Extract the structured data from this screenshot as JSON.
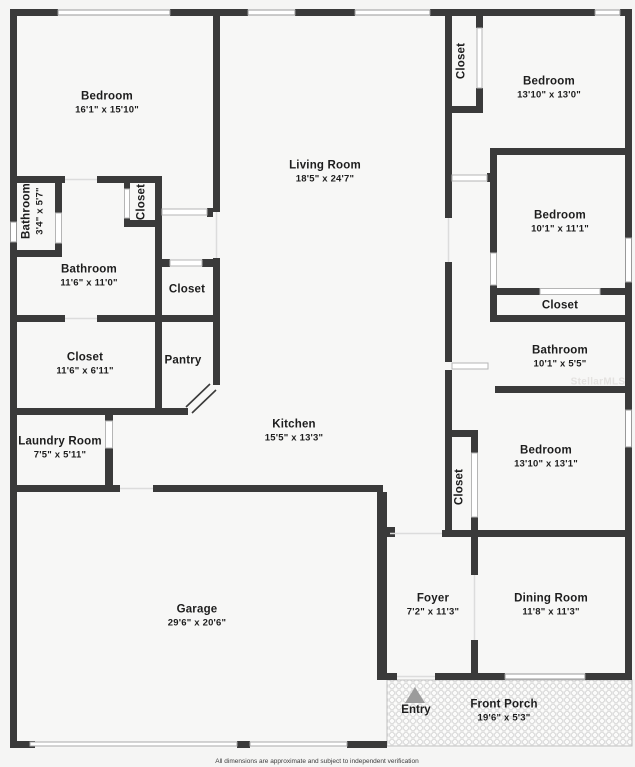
{
  "plan": {
    "rooms": [
      {
        "name": "Bedroom",
        "dims": "16'1\" x 15'10\""
      },
      {
        "name": "Living Room",
        "dims": "18'5\" x 24'7\""
      },
      {
        "name": "Closet",
        "dims": ""
      },
      {
        "name": "Bedroom",
        "dims": "13'10\" x 13'0\""
      },
      {
        "name": "Bedroom",
        "dims": "10'1\" x 11'1\""
      },
      {
        "name": "Closet",
        "dims": ""
      },
      {
        "name": "Bathroom",
        "dims": "10'1\" x 5'5\""
      },
      {
        "name": "Closet",
        "dims": ""
      },
      {
        "name": "Bathroom",
        "dims": "11'6\" x 11'0\""
      },
      {
        "name": "Closet",
        "dims": "11'6\" x 6'11\""
      },
      {
        "name": "Pantry",
        "dims": ""
      },
      {
        "name": "Bathroom",
        "dims": "3'4\" x 5'7\""
      },
      {
        "name": "Closet",
        "dims": ""
      },
      {
        "name": "Kitchen",
        "dims": "15'5\" x 13'3\""
      },
      {
        "name": "Laundry Room",
        "dims": "7'5\" x 5'11\""
      },
      {
        "name": "Garage",
        "dims": "29'6\" x 20'6\""
      },
      {
        "name": "Bedroom",
        "dims": "13'10\" x 13'1\""
      },
      {
        "name": "Closet",
        "dims": ""
      },
      {
        "name": "Foyer",
        "dims": "7'2\" x 11'3\""
      },
      {
        "name": "Dining Room",
        "dims": "11'8\" x 11'3\""
      },
      {
        "name": "Front Porch",
        "dims": "19'6\" x 5'3\""
      }
    ],
    "entry_label": "Entry",
    "watermark": "StellarMLS",
    "disclaimer": "All dimensions are approximate and subject to independent verification",
    "colors": {
      "wall": "#3a3a3a",
      "interior": "#f7f7f6",
      "background": "#f5f5f4",
      "window_stroke": "#999999",
      "entry_arrow": "#9b9b9b"
    }
  }
}
